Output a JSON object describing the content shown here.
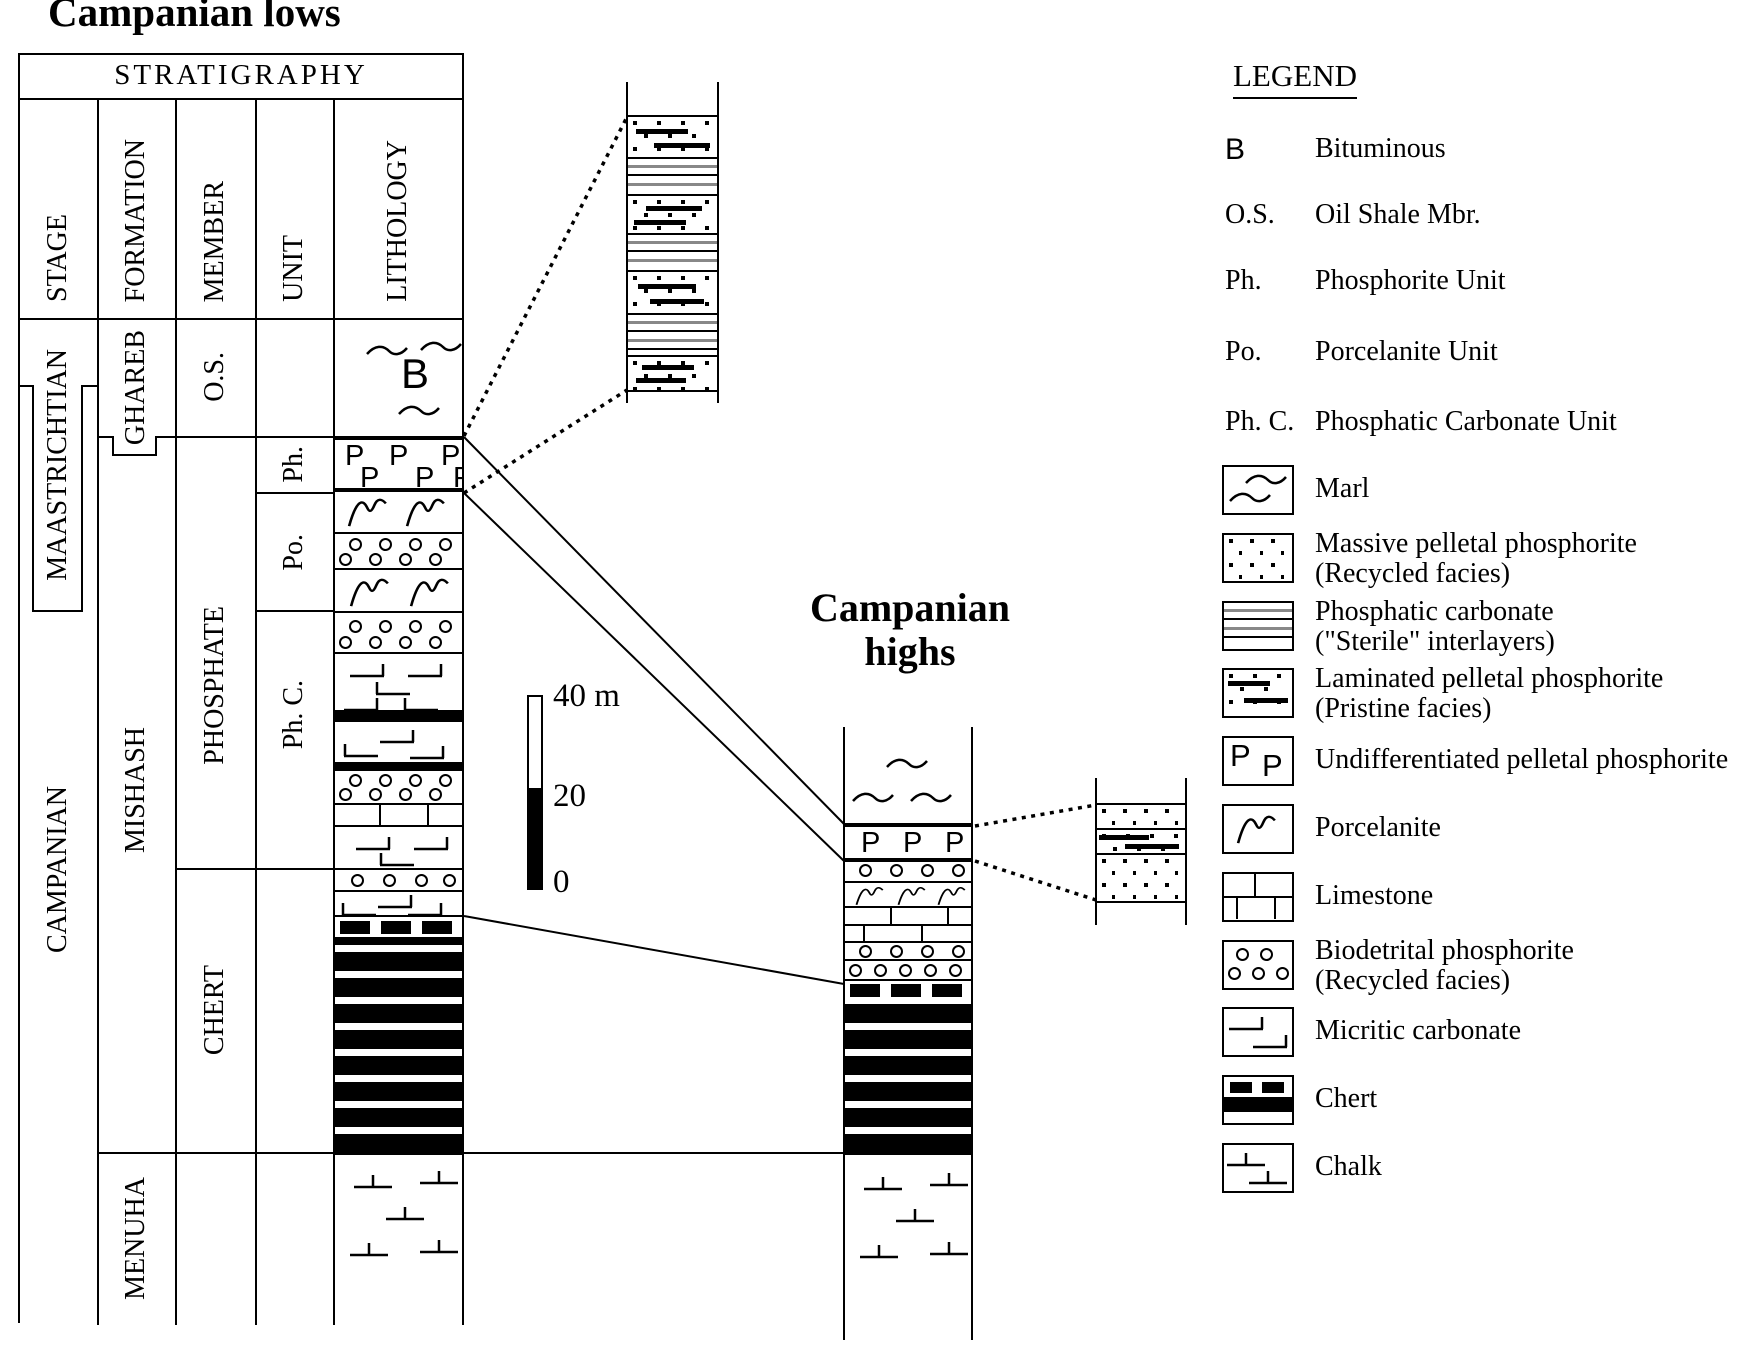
{
  "titles": {
    "left": "Campanian lows",
    "right_line1": "Campanian",
    "right_line2": "highs"
  },
  "table": {
    "header": "STRATIGRAPHY",
    "col_headers": [
      "STAGE",
      "FORMATION",
      "MEMBER",
      "UNIT",
      "LITHOLOGY"
    ],
    "stages": [
      "MAASTRICHTIAN",
      "CAMPANIAN"
    ],
    "formations": [
      "GHAREB",
      "MISHASH",
      "MENUHA"
    ],
    "members": [
      "O.S.",
      "PHOSPHATE",
      "CHERT"
    ],
    "units": [
      "Ph.",
      "Po.",
      "Ph. C."
    ]
  },
  "scale_bar": {
    "top": "40 m",
    "middle": "20",
    "bottom": "0"
  },
  "letters": {
    "bituminous": "B",
    "phosphorite": "P"
  },
  "legend": {
    "heading": "LEGEND",
    "abbreviations": [
      {
        "abbr": "B",
        "label": "Bituminous"
      },
      {
        "abbr": "O.S.",
        "label": "Oil Shale Mbr."
      },
      {
        "abbr": "Ph.",
        "label": "Phosphorite Unit"
      },
      {
        "abbr": "Po.",
        "label": "Porcelanite Unit"
      },
      {
        "abbr": "Ph. C.",
        "label": "Phosphatic Carbonate Unit"
      }
    ],
    "patterns": [
      {
        "key": "marl",
        "l1": "Marl",
        "l2": ""
      },
      {
        "key": "massive",
        "l1": "Massive pelletal phosphorite",
        "l2": "(Recycled facies)"
      },
      {
        "key": "sterile",
        "l1": "Phosphatic carbonate",
        "l2": "(\"Sterile\" interlayers)"
      },
      {
        "key": "laminated",
        "l1": "Laminated pelletal phosphorite",
        "l2": "(Pristine facies)"
      },
      {
        "key": "pband",
        "l1": "Undifferentiated pelletal phosphorite",
        "l2": ""
      },
      {
        "key": "porc",
        "l1": "Porcelanite",
        "l2": ""
      },
      {
        "key": "limestone",
        "l1": "Limestone",
        "l2": ""
      },
      {
        "key": "biodetrital",
        "l1": "Biodetrital phosphorite",
        "l2": "(Recycled facies)"
      },
      {
        "key": "micritic",
        "l1": "Micritic carbonate",
        "l2": ""
      },
      {
        "key": "chert",
        "l1": "Chert",
        "l2": ""
      },
      {
        "key": "chalk",
        "l1": "Chalk",
        "l2": ""
      }
    ]
  },
  "lithology": {
    "lows_bands": [
      {
        "p": "marl",
        "h": 118,
        "sq": [
          [
            30,
            26
          ],
          [
            84,
            22
          ],
          [
            62,
            86
          ]
        ],
        "b": [
          66,
          32
        ]
      },
      {
        "p": "pband",
        "h": 56,
        "bt": 4,
        "bb": 4,
        "pp": [
          [
            10,
            2
          ],
          [
            54,
            2
          ],
          [
            106,
            2
          ],
          [
            25,
            24
          ],
          [
            80,
            24
          ],
          [
            118,
            24
          ]
        ]
      },
      {
        "p": "porc",
        "h": 40,
        "g": [
          [
            12,
            2
          ],
          [
            70,
            2
          ]
        ]
      },
      {
        "p": "circles",
        "h": 36,
        "bt": 2,
        "c": [
          [
            14,
            4
          ],
          [
            44,
            4
          ],
          [
            74,
            4
          ],
          [
            104,
            4
          ],
          [
            4,
            19
          ],
          [
            34,
            19
          ],
          [
            64,
            19
          ],
          [
            94,
            19
          ]
        ]
      },
      {
        "p": "porc",
        "h": 43,
        "bt": 2,
        "g": [
          [
            14,
            4
          ],
          [
            74,
            4
          ]
        ]
      },
      {
        "p": "circles",
        "h": 41,
        "bt": 2,
        "c": [
          [
            14,
            7
          ],
          [
            44,
            7
          ],
          [
            74,
            7
          ],
          [
            104,
            7
          ],
          [
            4,
            23
          ],
          [
            34,
            23
          ],
          [
            64,
            23
          ],
          [
            94,
            23
          ]
        ]
      },
      {
        "p": "micritic",
        "h": 58,
        "bt": 2,
        "m": [
          [
            14,
            8,
            0
          ],
          [
            72,
            8,
            0
          ],
          [
            40,
            26,
            1
          ],
          [
            8,
            42,
            0
          ],
          [
            68,
            42,
            1
          ]
        ]
      },
      {
        "p": "black",
        "h": 12
      },
      {
        "p": "micritic",
        "h": 40,
        "m": [
          [
            44,
            6,
            0
          ],
          [
            8,
            20,
            1
          ],
          [
            74,
            22,
            0
          ]
        ]
      },
      {
        "p": "black",
        "h": 9
      },
      {
        "p": "circles",
        "h": 32,
        "c": [
          [
            14,
            3
          ],
          [
            44,
            3
          ],
          [
            74,
            3
          ],
          [
            104,
            3
          ],
          [
            4,
            17
          ],
          [
            34,
            17
          ],
          [
            64,
            17
          ],
          [
            94,
            17
          ]
        ]
      },
      {
        "p": "limestone",
        "h": 22,
        "bt": 2,
        "rows": [
          [
            44,
            92
          ]
        ]
      },
      {
        "p": "micritic",
        "h": 43,
        "bt": 2,
        "m": [
          [
            20,
            8,
            0
          ],
          [
            78,
            8,
            0
          ],
          [
            44,
            24,
            1
          ]
        ]
      },
      {
        "p": "circles",
        "h": 22,
        "bt": 2,
        "c": [
          [
            16,
            4
          ],
          [
            48,
            4
          ],
          [
            80,
            4
          ],
          [
            108,
            4
          ]
        ]
      },
      {
        "p": "micritic",
        "h": 25,
        "bt": 2,
        "m": [
          [
            42,
            1,
            0
          ],
          [
            6,
            9,
            1
          ],
          [
            72,
            9,
            0
          ]
        ]
      },
      {
        "p": "chertdash",
        "h": 22,
        "bt": 2,
        "d": [
          [
            5,
            4
          ],
          [
            46,
            4
          ],
          [
            87,
            4
          ]
        ]
      },
      {
        "p": "stripes",
        "h": 216
      },
      {
        "p": "chalk",
        "h": 172,
        "bt": 2,
        "k": [
          [
            18,
            18
          ],
          [
            84,
            14
          ],
          [
            50,
            50
          ],
          [
            14,
            86
          ],
          [
            84,
            83
          ]
        ]
      }
    ],
    "highs_bands": [
      {
        "p": "marl",
        "h": 96,
        "sq": [
          [
            40,
            30
          ],
          [
            6,
            64
          ],
          [
            64,
            64
          ]
        ]
      },
      {
        "p": "pband",
        "h": 39,
        "bt": 4,
        "bb": 4,
        "pp": [
          [
            16,
            2
          ],
          [
            58,
            2
          ],
          [
            100,
            2
          ]
        ]
      },
      {
        "p": "circles",
        "h": 19,
        "c": [
          [
            14,
            2
          ],
          [
            45,
            2
          ],
          [
            76,
            2
          ],
          [
            107,
            2
          ]
        ]
      },
      {
        "p": "porc",
        "h": 25,
        "bt": 2,
        "small": true,
        "g": [
          [
            10,
            1
          ],
          [
            52,
            1
          ],
          [
            92,
            1
          ]
        ]
      },
      {
        "p": "limestone",
        "h": 35,
        "bt": 2,
        "rows": [
          [
            45,
            102
          ],
          [
            18,
            76
          ]
        ]
      },
      {
        "p": "circles",
        "h": 18,
        "bt": 2,
        "c": [
          [
            14,
            2
          ],
          [
            45,
            2
          ],
          [
            76,
            2
          ],
          [
            107,
            2
          ]
        ]
      },
      {
        "p": "circles",
        "h": 20,
        "bt": 2,
        "c": [
          [
            4,
            3
          ],
          [
            29,
            3
          ],
          [
            54,
            3
          ],
          [
            79,
            3
          ],
          [
            104,
            3
          ]
        ]
      },
      {
        "p": "chertdash",
        "h": 19,
        "bt": 2,
        "d": [
          [
            5,
            3
          ],
          [
            46,
            3
          ],
          [
            87,
            3
          ]
        ]
      },
      {
        "p": "stripes",
        "h": 155
      },
      {
        "p": "chalk",
        "h": 177,
        "bt": 2,
        "k": [
          [
            18,
            20
          ],
          [
            84,
            16
          ],
          [
            50,
            52
          ],
          [
            14,
            88
          ],
          [
            84,
            85
          ]
        ]
      }
    ],
    "inset_top_bands": [
      {
        "p": "empty",
        "h": 33
      },
      {
        "p": "laminated",
        "h": 42,
        "bt": 2,
        "dash": [
          [
            8,
            12,
            52
          ],
          [
            26,
            26,
            56
          ]
        ]
      },
      {
        "p": "sterile",
        "h": 37,
        "bt": 2
      },
      {
        "p": "laminated",
        "h": 39,
        "bt": 2,
        "dash": [
          [
            18,
            10,
            56
          ],
          [
            6,
            24,
            52
          ]
        ]
      },
      {
        "p": "sterile",
        "h": 37,
        "bt": 2
      },
      {
        "p": "laminated",
        "h": 43,
        "bt": 2,
        "dash": [
          [
            10,
            12,
            58
          ],
          [
            22,
            27,
            54
          ]
        ]
      },
      {
        "p": "sterile",
        "h": 42,
        "bt": 2
      },
      {
        "p": "laminated",
        "h": 37,
        "bt": 2,
        "bb": 2,
        "dash": [
          [
            14,
            8,
            52
          ],
          [
            8,
            21,
            50
          ]
        ]
      }
    ],
    "inset_right_bands": [
      {
        "p": "empty",
        "h": 25
      },
      {
        "p": "massive",
        "h": 25,
        "bt": 2
      },
      {
        "p": "laminated",
        "h": 25,
        "bt": 2,
        "dash": [
          [
            2,
            5,
            50
          ],
          [
            28,
            14,
            54
          ]
        ]
      },
      {
        "p": "massive",
        "h": 50,
        "bt": 2,
        "bb": 2
      }
    ]
  }
}
